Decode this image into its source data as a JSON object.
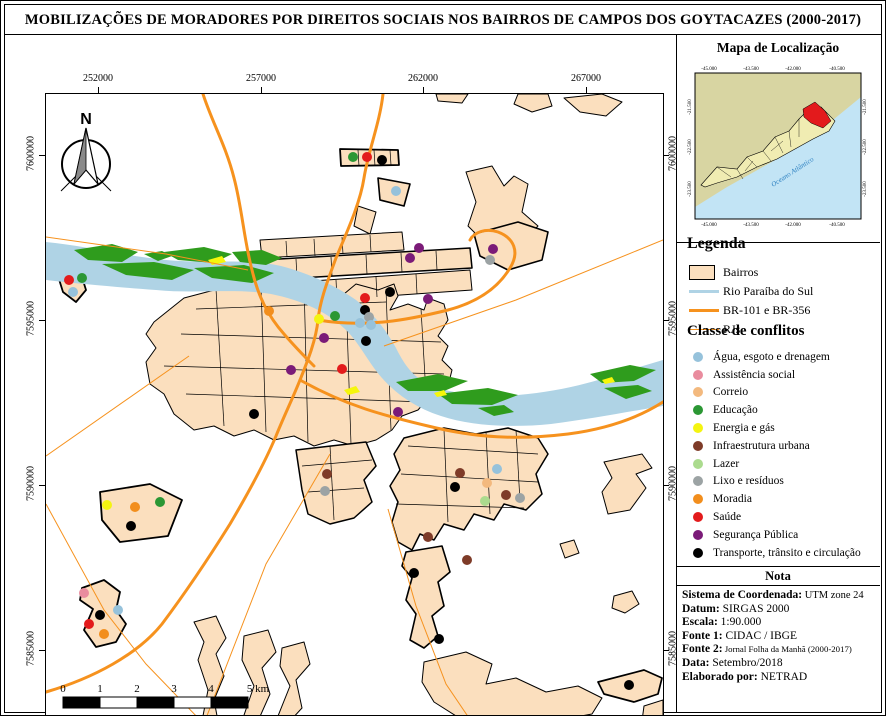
{
  "title": "MOBILIZAÇÕES DE MORADORES POR DIREITOS SOCIAIS NOS BAIRROS DE CAMPOS DOS GOYTACAZES (2000-2017)",
  "map": {
    "top_ticks": [
      "252000",
      "257000",
      "262000",
      "267000"
    ],
    "bottom_ticks": [
      "252000",
      "257000",
      "262000",
      "267000"
    ],
    "left_ticks": [
      "7600000",
      "7595000",
      "7590000",
      "7585000"
    ],
    "right_ticks": [
      "7600000",
      "7595000",
      "7590000",
      "7585000"
    ],
    "north_label": "N",
    "scalebar": {
      "tick_labels": [
        "0",
        "1",
        "2",
        "3",
        "4"
      ],
      "end_label": "5 km"
    }
  },
  "inset": {
    "title": "Mapa de Localização",
    "ocean_label": "Oceano Atlântico",
    "top_ticks": [
      "-45.000",
      "-43.500",
      "-42.000",
      "-40.500"
    ],
    "bottom_ticks": [
      "-45.000",
      "-43.500",
      "-42.000",
      "-40.500"
    ],
    "left_ticks": [
      "-21.500",
      "-22.500",
      "-23.500"
    ],
    "right_ticks": [
      "-21.500",
      "-22.500",
      "-23.500"
    ]
  },
  "legend": {
    "heading": "Legenda",
    "items": [
      {
        "label": "Bairros",
        "type": "fill",
        "color": "#FBDFBE"
      },
      {
        "label": "Rio Paraíba do Sul",
        "type": "line",
        "color": "#AFD3E5",
        "weight": 3
      },
      {
        "label": "BR-101 e BR-356",
        "type": "line",
        "color": "#F6921E",
        "weight": 3
      },
      {
        "label": "RJs",
        "type": "line",
        "color": "#F6921E",
        "weight": 1
      }
    ]
  },
  "classes": {
    "heading": "Classe de conflitos",
    "items": [
      {
        "id": "agua",
        "label": "Água, esgoto e drenagem",
        "color": "#96C2DB"
      },
      {
        "id": "assistencia",
        "label": "Assistência social",
        "color": "#E98C9E"
      },
      {
        "id": "correio",
        "label": "Correio",
        "color": "#F3B97E"
      },
      {
        "id": "educacao",
        "label": "Educação",
        "color": "#2B9734"
      },
      {
        "id": "energia",
        "label": "Energia e gás",
        "color": "#F4F411"
      },
      {
        "id": "infraestrutura",
        "label": "Infraestrutura urbana",
        "color": "#7E3B28"
      },
      {
        "id": "lazer",
        "label": "Lazer",
        "color": "#ABDB8E"
      },
      {
        "id": "lixo",
        "label": "Lixo e resíduos",
        "color": "#9CA3A4"
      },
      {
        "id": "moradia",
        "label": "Moradia",
        "color": "#F28E1D"
      },
      {
        "id": "saude",
        "label": "Saúde",
        "color": "#E31B1C"
      },
      {
        "id": "seguranca",
        "label": "Segurança Pública",
        "color": "#7B1B78"
      },
      {
        "id": "transporte",
        "label": "Transporte, trânsito e circulação",
        "color": "#000000"
      }
    ]
  },
  "nota": {
    "heading": "Nota",
    "rows": [
      {
        "label": "Sistema de Coordenada:",
        "value": "UTM zone 24"
      },
      {
        "label": "Datum:",
        "value": "SIRGAS 2000"
      },
      {
        "label": "Escala:",
        "value": "1:90.000"
      },
      {
        "label": "Fonte 1:",
        "value": "CIDAC / IBGE"
      },
      {
        "label": "Fonte 2:",
        "value": "Jornal Folha da Manhã (2000-2017)"
      },
      {
        "label": "Data:",
        "value": "Setembro/2018"
      },
      {
        "label": "Elaborado por:",
        "value": "NETRAD"
      }
    ]
  },
  "markers": [
    {
      "c": "saude",
      "x": 23,
      "y": 186
    },
    {
      "c": "educacao",
      "x": 36,
      "y": 184
    },
    {
      "c": "agua",
      "x": 27,
      "y": 198
    },
    {
      "c": "educacao",
      "x": 307,
      "y": 63
    },
    {
      "c": "saude",
      "x": 321,
      "y": 63
    },
    {
      "c": "transporte",
      "x": 336,
      "y": 66
    },
    {
      "c": "agua",
      "x": 350,
      "y": 97
    },
    {
      "c": "seguranca",
      "x": 373,
      "y": 154
    },
    {
      "c": "seguranca",
      "x": 364,
      "y": 164
    },
    {
      "c": "seguranca",
      "x": 447,
      "y": 155
    },
    {
      "c": "lixo",
      "x": 444,
      "y": 166
    },
    {
      "c": "moradia",
      "x": 223,
      "y": 217
    },
    {
      "c": "transporte",
      "x": 344,
      "y": 198
    },
    {
      "c": "saude",
      "x": 319,
      "y": 204
    },
    {
      "c": "seguranca",
      "x": 382,
      "y": 205
    },
    {
      "c": "transporte",
      "x": 319,
      "y": 216
    },
    {
      "c": "educacao",
      "x": 289,
      "y": 222
    },
    {
      "c": "energia",
      "x": 273,
      "y": 225
    },
    {
      "c": "lixo",
      "x": 323,
      "y": 223
    },
    {
      "c": "agua",
      "x": 314,
      "y": 229
    },
    {
      "c": "agua",
      "x": 325,
      "y": 231
    },
    {
      "c": "seguranca",
      "x": 278,
      "y": 244
    },
    {
      "c": "transporte",
      "x": 320,
      "y": 247
    },
    {
      "c": "seguranca",
      "x": 245,
      "y": 276
    },
    {
      "c": "saude",
      "x": 296,
      "y": 275
    },
    {
      "c": "seguranca",
      "x": 352,
      "y": 318
    },
    {
      "c": "transporte",
      "x": 208,
      "y": 320
    },
    {
      "c": "infraestrutura",
      "x": 414,
      "y": 379
    },
    {
      "c": "agua",
      "x": 451,
      "y": 375
    },
    {
      "c": "transporte",
      "x": 409,
      "y": 393
    },
    {
      "c": "correio",
      "x": 441,
      "y": 389
    },
    {
      "c": "infraestrutura",
      "x": 460,
      "y": 401
    },
    {
      "c": "lixo",
      "x": 474,
      "y": 404
    },
    {
      "c": "lazer",
      "x": 439,
      "y": 407
    },
    {
      "c": "infraestrutura",
      "x": 382,
      "y": 443
    },
    {
      "c": "infraestrutura",
      "x": 421,
      "y": 466
    },
    {
      "c": "transporte",
      "x": 368,
      "y": 479
    },
    {
      "c": "transporte",
      "x": 393,
      "y": 545
    },
    {
      "c": "transporte",
      "x": 583,
      "y": 591
    },
    {
      "c": "infraestrutura",
      "x": 281,
      "y": 380
    },
    {
      "c": "lixo",
      "x": 279,
      "y": 397
    },
    {
      "c": "energia",
      "x": 61,
      "y": 411
    },
    {
      "c": "moradia",
      "x": 89,
      "y": 413
    },
    {
      "c": "educacao",
      "x": 114,
      "y": 408
    },
    {
      "c": "transporte",
      "x": 85,
      "y": 432
    },
    {
      "c": "assistencia",
      "x": 38,
      "y": 499
    },
    {
      "c": "agua",
      "x": 72,
      "y": 516
    },
    {
      "c": "transporte",
      "x": 54,
      "y": 521
    },
    {
      "c": "saude",
      "x": 43,
      "y": 530
    },
    {
      "c": "moradia",
      "x": 58,
      "y": 540
    }
  ]
}
